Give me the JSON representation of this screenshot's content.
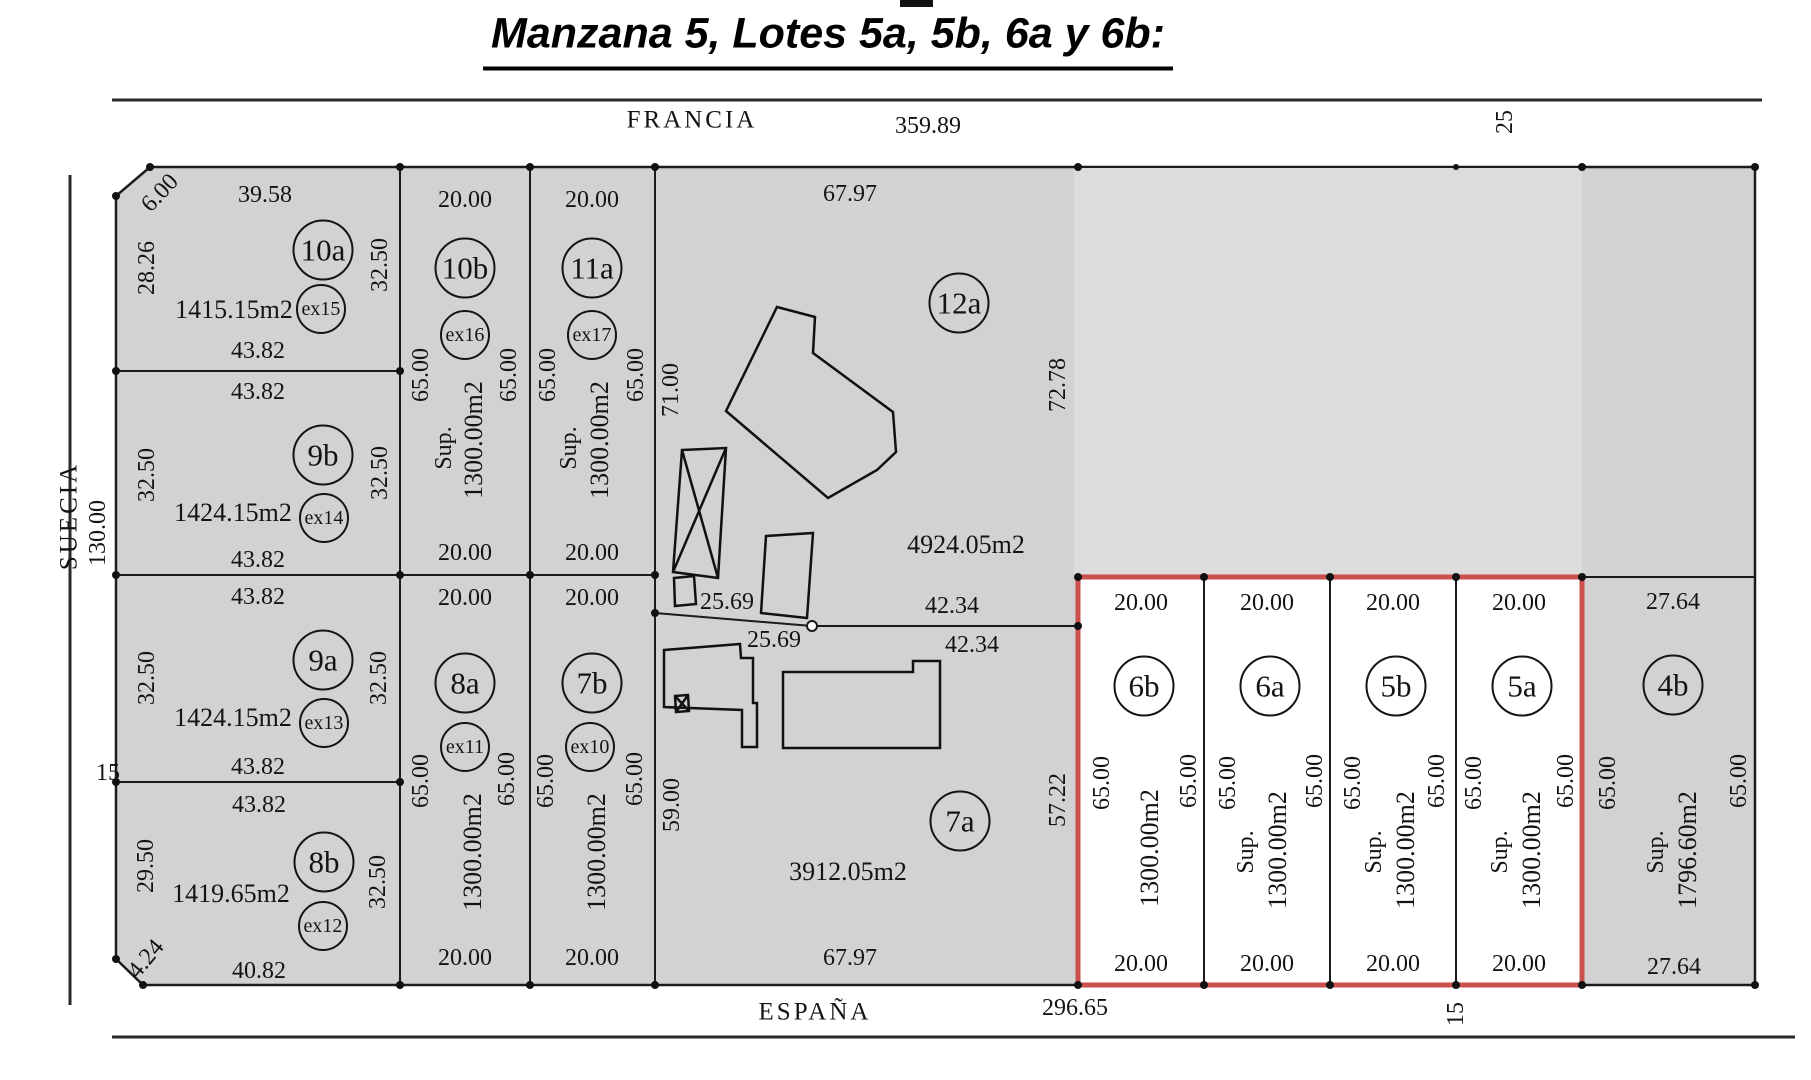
{
  "title": "Manzana 5, Lotes 5a, 5b, 6a y 6b:",
  "streets": {
    "top": "FRANCIA",
    "left": "SUECIA",
    "bottom": "ESPAÑA"
  },
  "totals": {
    "francia": "359.89",
    "suecia": "130.00",
    "espana": "296.65",
    "left_street_width": "15",
    "top_right": "25",
    "bottom_right": "15"
  },
  "boundary": {
    "left_upper": "25.69",
    "left_lower": "25.69",
    "right_upper": "42.34",
    "right_lower": "42.34"
  },
  "lots": {
    "l10a": {
      "name": "10a",
      "ex": "ex15",
      "area": "1415.15m2",
      "top": "39.58",
      "bottom": "43.82",
      "left": "28.26",
      "right": "32.50",
      "chamfer": "6.00"
    },
    "l9b": {
      "name": "9b",
      "ex": "ex14",
      "area": "1424.15m2",
      "top": "43.82",
      "bottom": "43.82",
      "left": "32.50",
      "right": "32.50"
    },
    "l9a": {
      "name": "9a",
      "ex": "ex13",
      "area": "1424.15m2",
      "top": "43.82",
      "bottom": "43.82",
      "left": "32.50",
      "right": "32.50"
    },
    "l8b": {
      "name": "8b",
      "ex": "ex12",
      "area": "1419.65m2",
      "top": "43.82",
      "bottom": "40.82",
      "left": "29.50",
      "right": "32.50",
      "chamfer": "4.24"
    },
    "l10b": {
      "name": "10b",
      "ex": "ex16",
      "sup": "Sup.",
      "area": "1300.00m2",
      "top": "20.00",
      "bottom": "20.00",
      "left": "65.00",
      "right": "65.00"
    },
    "l11a": {
      "name": "11a",
      "ex": "ex17",
      "sup": "Sup.",
      "area": "1300.00m2",
      "top": "20.00",
      "bottom": "20.00",
      "left": "65.00",
      "right": "65.00"
    },
    "l8a": {
      "name": "8a",
      "ex": "ex11",
      "area": "1300.00m2",
      "top": "20.00",
      "bottom": "20.00",
      "left": "65.00",
      "right": "65.00"
    },
    "l7b": {
      "name": "7b",
      "ex": "ex10",
      "area": "1300.00m2",
      "top": "20.00",
      "bottom": "20.00",
      "left": "65.00",
      "right": "65.00"
    },
    "l12a": {
      "name": "12a",
      "area": "4924.05m2",
      "top": "67.97",
      "left": "71.00",
      "right": "72.78"
    },
    "l7a": {
      "name": "7a",
      "area": "3912.05m2",
      "bottom": "67.97",
      "left": "59.00",
      "right": "57.22"
    },
    "l6b": {
      "name": "6b",
      "area": "1300.00m2",
      "top": "20.00",
      "bottom": "20.00",
      "left": "65.00",
      "right": "65.00"
    },
    "l6a": {
      "name": "6a",
      "sup": "Sup.",
      "area": "1300.00m2",
      "top": "20.00",
      "bottom": "20.00",
      "left": "65.00",
      "right": "65.00"
    },
    "l5b": {
      "name": "5b",
      "sup": "Sup.",
      "area": "1300.00m2",
      "top": "20.00",
      "bottom": "20.00",
      "left": "65.00",
      "right": "65.00"
    },
    "l5a": {
      "name": "5a",
      "sup": "Sup.",
      "area": "1300.00m2",
      "top": "20.00",
      "bottom": "20.00",
      "left": "65.00",
      "right": "65.00"
    },
    "l4b": {
      "name": "4b",
      "sup": "Sup.",
      "area": "1796.60m2",
      "top": "27.64",
      "bottom": "27.64",
      "left": "65.00",
      "right": "65.00"
    }
  },
  "colors": {
    "parcel_gray": "#d2d2d2",
    "parcel_light": "#dcdcdc",
    "highlight_red": "#c9504c",
    "line": "#1b1b1b"
  }
}
